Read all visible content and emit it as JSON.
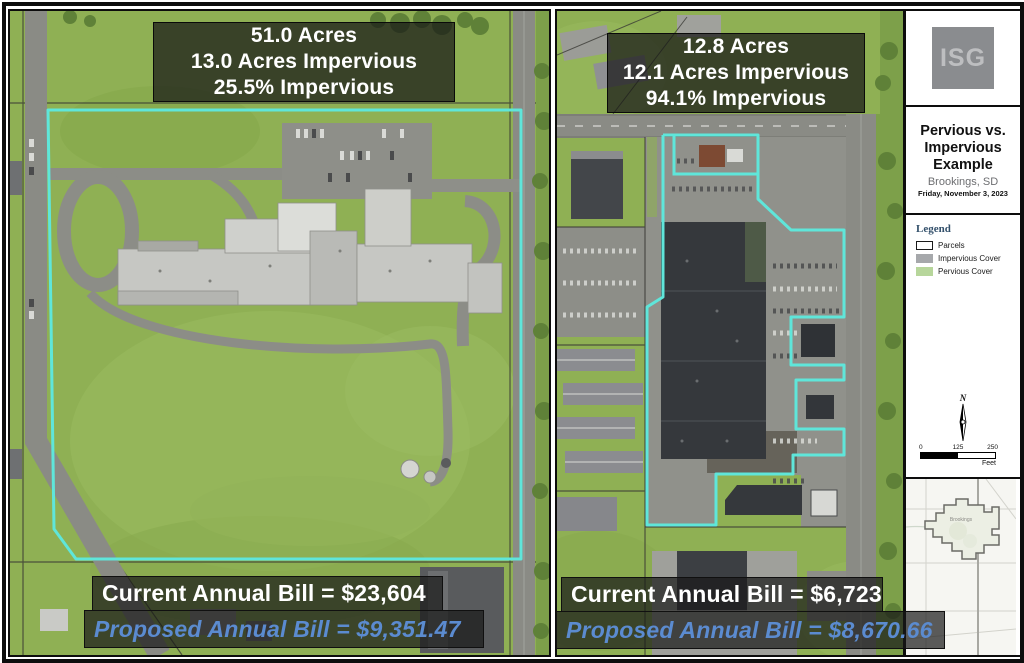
{
  "panels": {
    "left": {
      "stats": [
        "51.0 Acres",
        "13.0 Acres Impervious",
        "25.5% Impervious"
      ],
      "current_bill": "Current Annual Bill = $23,604",
      "proposed_bill": "Proposed Annual Bill = $9,351.47"
    },
    "right": {
      "stats": [
        "12.8 Acres",
        "12.1 Acres Impervious",
        "94.1% Impervious"
      ],
      "current_bill": "Current Annual Bill = $6,723",
      "proposed_bill": "Proposed Annual Bill = $8,670.66"
    }
  },
  "sidebar": {
    "logo_text": "ISG",
    "title": [
      "Pervious vs.",
      "Impervious",
      "Example"
    ],
    "location": "Brookings, SD",
    "date": "Friday, November 3, 2023",
    "legend": {
      "title": "Legend",
      "items": [
        {
          "label": "Parcels"
        },
        {
          "label": "Impervious Cover"
        },
        {
          "label": "Pervious Cover"
        }
      ]
    },
    "north_label": "N",
    "scalebar": {
      "ticks": [
        "0",
        "125",
        "250"
      ],
      "unit": "Feet"
    },
    "locator": {
      "city_label": "Brookings"
    }
  },
  "colors": {
    "parcel_outline_cyan": "#5FE6DA",
    "pervious_green": "#8FB054",
    "impervious_gray": "#A6A8AB",
    "legend_pervious_green": "#B7D69B",
    "proposed_text_blue": "#5B8BD0",
    "overlay_background": "rgba(24,24,24,0.72)"
  }
}
